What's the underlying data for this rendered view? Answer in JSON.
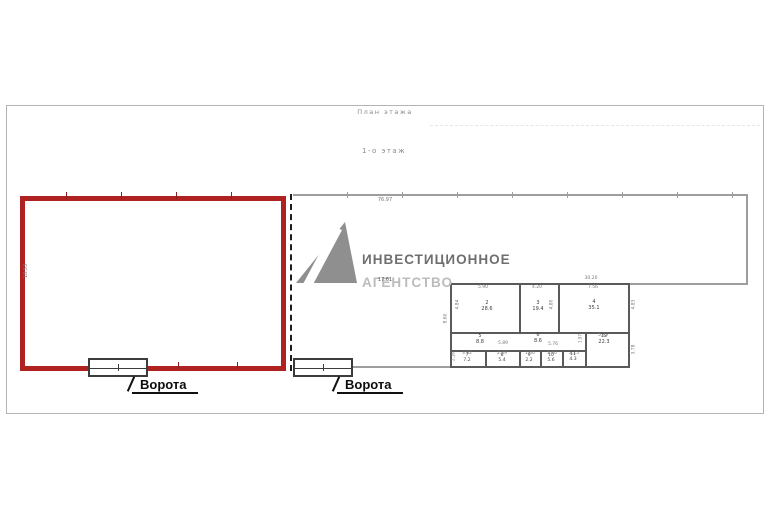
{
  "page": {
    "title": "План этажа",
    "floor_label": "1-о этаж"
  },
  "watermark": {
    "line1": "ИНВЕСТИЦИОННОЕ",
    "line2": "АГЕНТСТВО"
  },
  "plan": {
    "overall_width_dim": "76.97",
    "left_zone_height_dim": "18.53",
    "center_dim": "17.61",
    "block_width_dim": "30.20",
    "gate_label_1": "Ворота",
    "gate_label_2": "Ворота",
    "side_dims": {
      "v860": "8.60",
      "v484": "4.84",
      "v480": "4.80",
      "v483": "4.83",
      "v378": "3.78",
      "v216": "2.16",
      "v197": "1.97"
    },
    "rooms": [
      {
        "num": "2",
        "area": "28.6",
        "width_dim": "5.90"
      },
      {
        "num": "3",
        "area": "19.4",
        "width_dim": "4.20"
      },
      {
        "num": "4",
        "area": "35.1",
        "width_dim": "7.56"
      },
      {
        "num": "5",
        "area": "8.8",
        "width_dim": "5.89"
      },
      {
        "num": "6",
        "area": "8.6",
        "width_dim": "5.76"
      },
      {
        "num": "7",
        "area": "7.2",
        "width_dim": "3.32"
      },
      {
        "num": "8",
        "area": "5.4",
        "width_dim": "2.49"
      },
      {
        "num": "9",
        "area": "2.2",
        "width_dim": "1.60"
      },
      {
        "num": "10",
        "area": "5.6",
        "width_dim": "1.60"
      },
      {
        "num": "11",
        "area": "4.3",
        "width_dim": "2.15"
      },
      {
        "num": "12",
        "area": "22.3",
        "width_dim": "5.95"
      }
    ]
  },
  "colors": {
    "highlight_red": "#b02222",
    "wall_gray": "#9e9e9e",
    "inner_wall_gray": "#5a5a5a",
    "gate_text": "#0d0d0d",
    "dim_gray": "#777777",
    "watermark_gray": "#8f8f8f"
  }
}
